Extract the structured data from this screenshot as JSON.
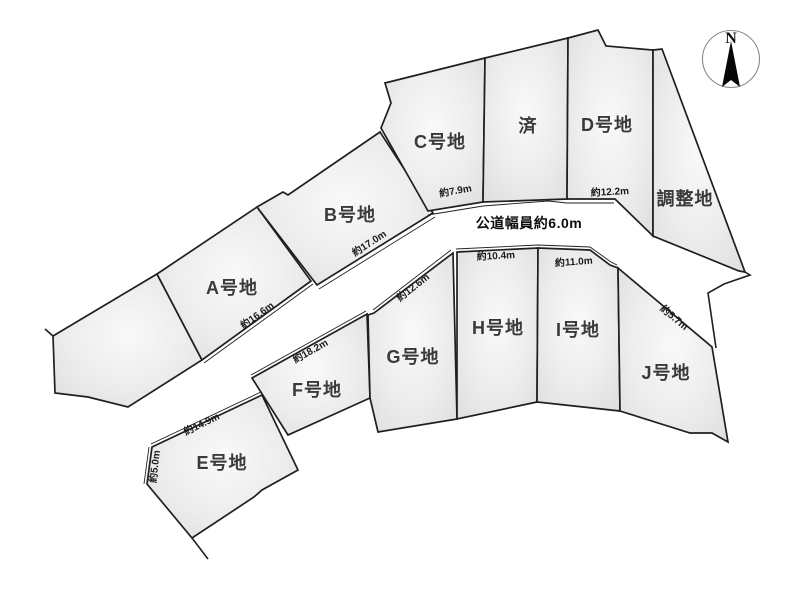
{
  "diagram": {
    "road_label": "公道幅員約6.0m",
    "compass_label": "N",
    "plots": {
      "vacant": {
        "label": ""
      },
      "a": {
        "label": "A号地"
      },
      "b": {
        "label": "B号地"
      },
      "c": {
        "label": "C号地"
      },
      "sold": {
        "label": "済"
      },
      "d": {
        "label": "D号地"
      },
      "adjustment": {
        "label": "調整地"
      },
      "e": {
        "label": "E号地"
      },
      "f": {
        "label": "F号地"
      },
      "g": {
        "label": "G号地"
      },
      "h": {
        "label": "H号地"
      },
      "i": {
        "label": "I号地"
      },
      "j": {
        "label": "J号地"
      }
    },
    "measurements": {
      "c_front": "約7.9m",
      "d_front": "約12.2m",
      "b_front": "約17.0m",
      "a_front": "約16.6m",
      "g_front": "約12.6m",
      "f_front": "約18.2m",
      "e_front": "約14.9m",
      "e_side": "約5.0m",
      "h_front": "約10.4m",
      "i_front": "約11.0m",
      "j_side": "約5.7m"
    },
    "colors": {
      "plot_fill": "#e4e4e4",
      "plot_fill_light": "#f9f9f9",
      "line": "#1f1f1f",
      "label_text": "#3a3a3a"
    }
  }
}
